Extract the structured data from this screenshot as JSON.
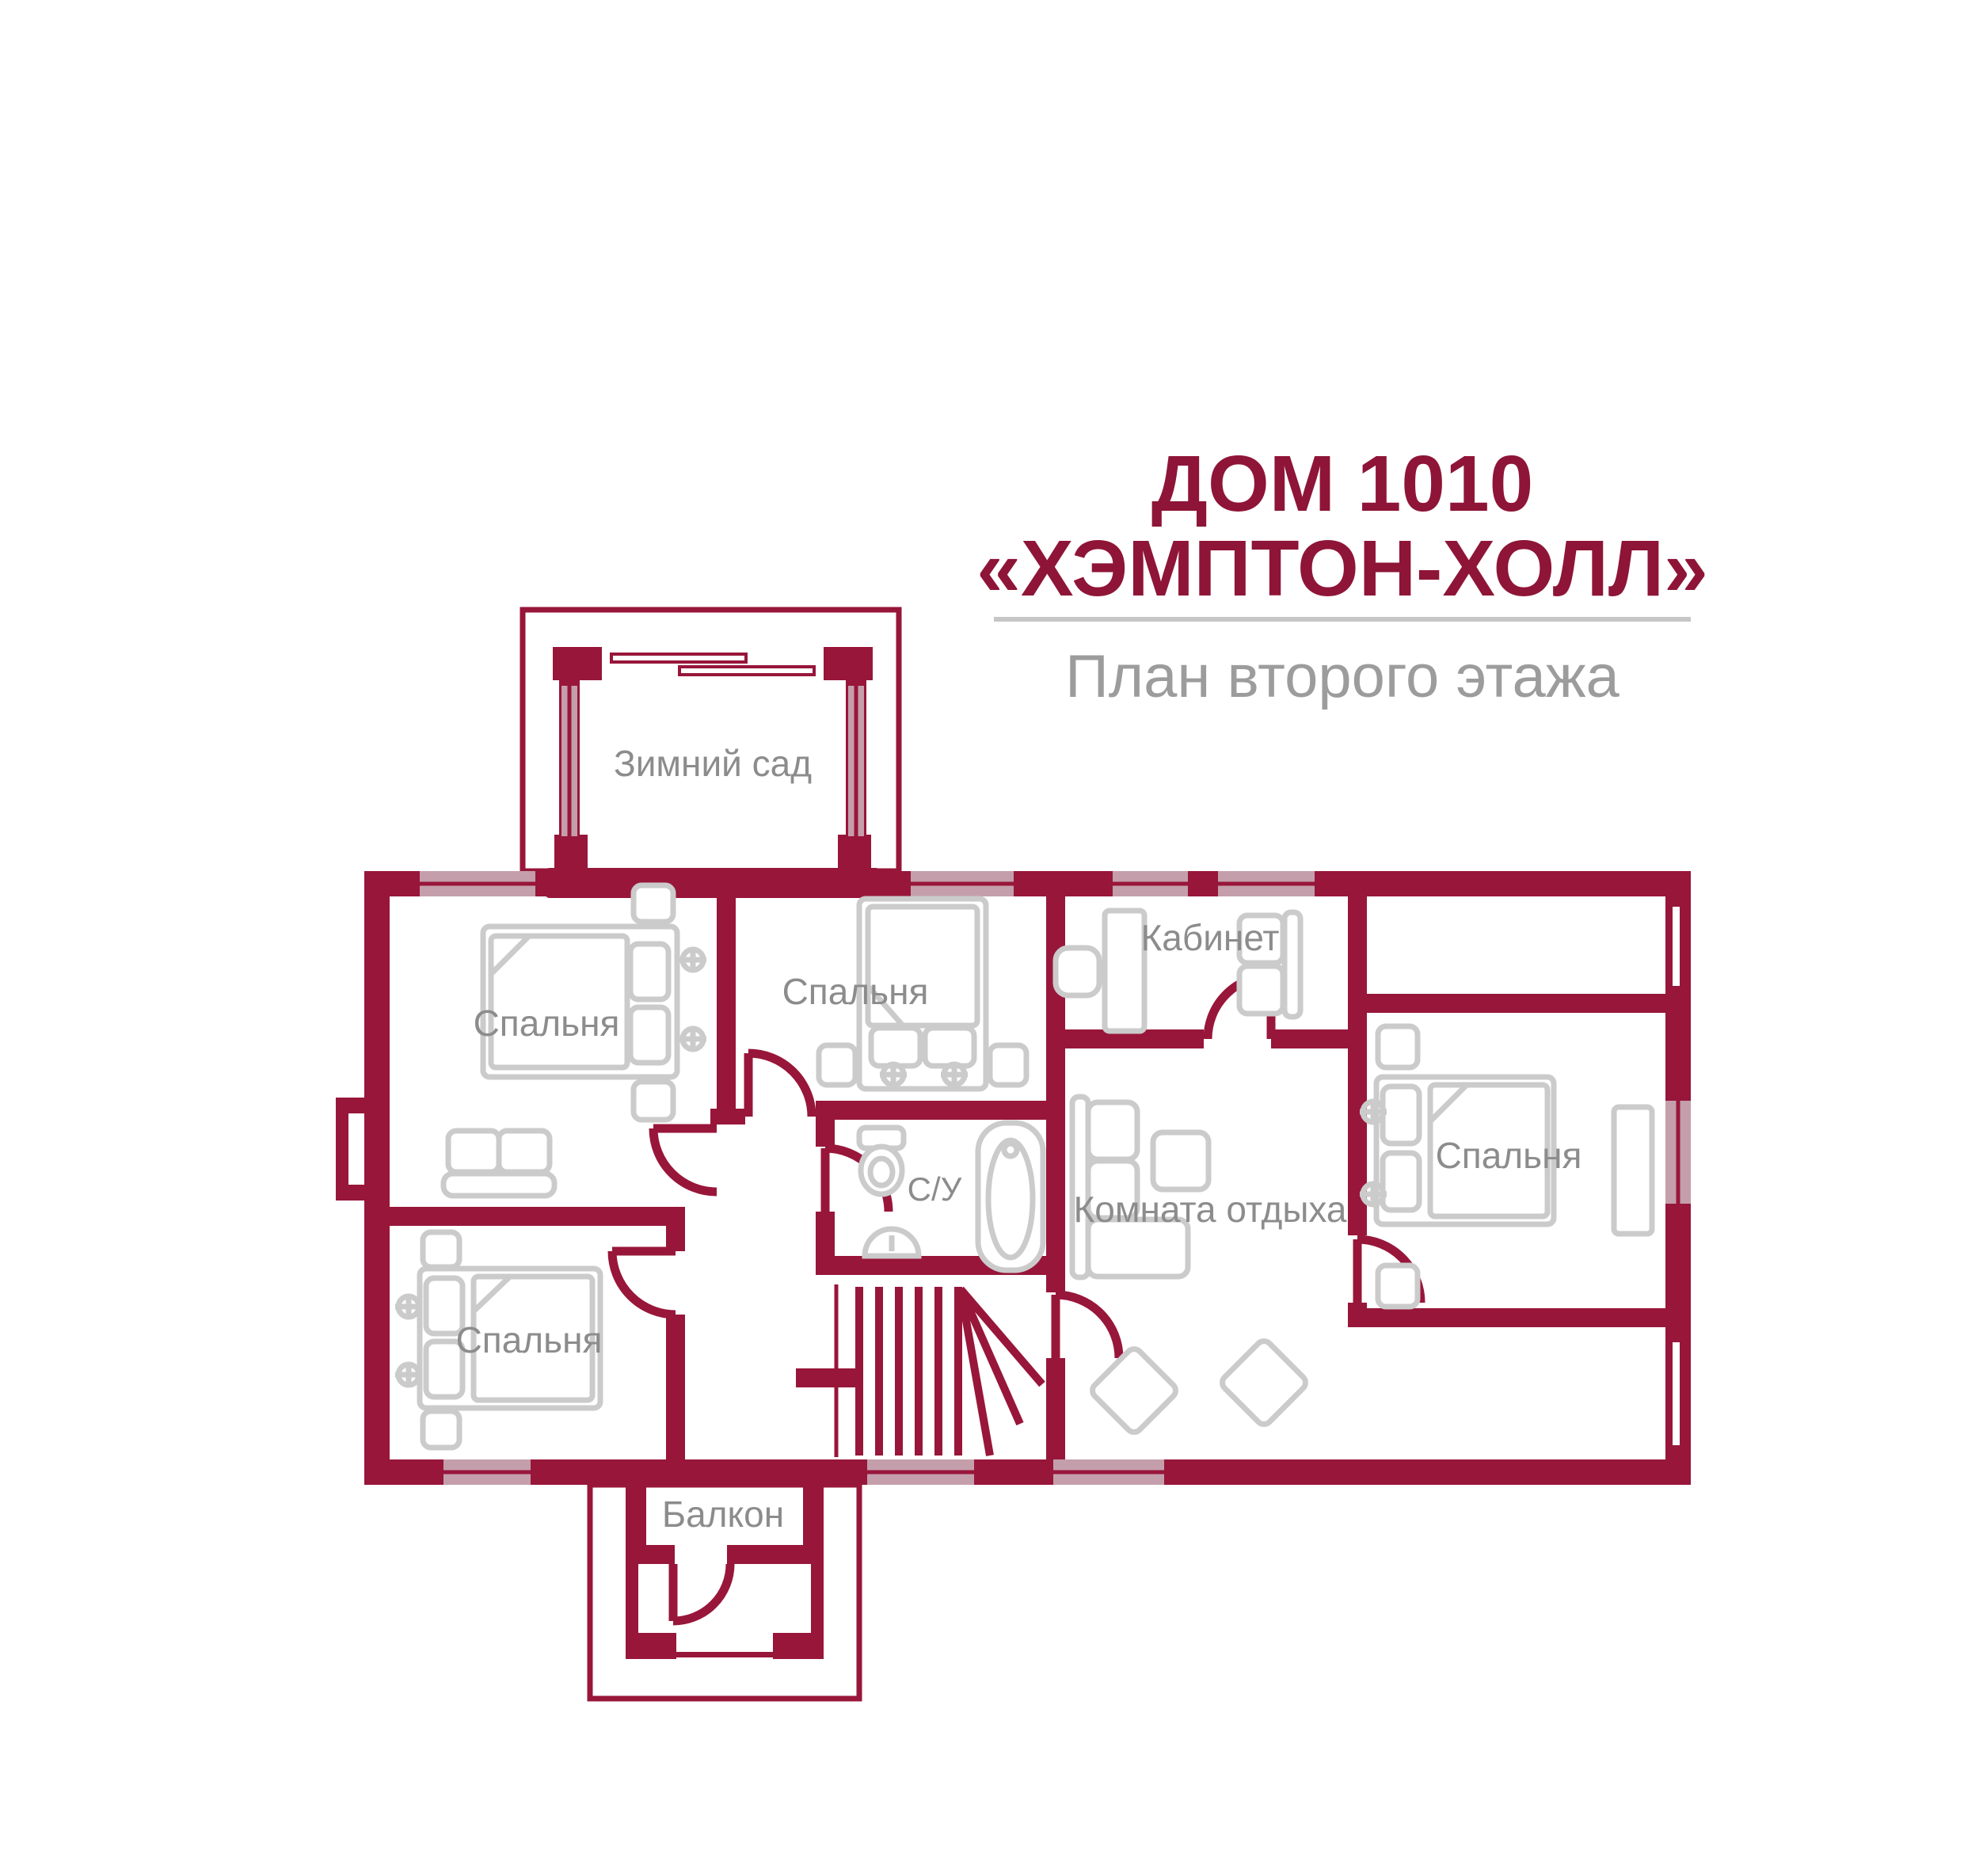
{
  "title": {
    "line1": "ДОМ 1010",
    "line2": "«ХЭМПТОН-ХОЛЛ»",
    "subtitle": "План второго этажа"
  },
  "rooms": {
    "winter_garden": "Зимний сад",
    "bedroom_top_left": "Спальня",
    "bedroom_top_middle": "Спальня",
    "study": "Кабинет",
    "bathroom": "С/У",
    "lounge": "Комната отдыха",
    "bedroom_right": "Спальня",
    "bedroom_bottom_left": "Спальня",
    "balcony": "Балкон"
  },
  "colors": {
    "wall": "#98163A",
    "window_glass": "#C49FAB",
    "furniture_outline": "#CBCBCB",
    "room_label": "#8C8C8C",
    "title_text": "#8E1537",
    "subtitle_text": "#9C9C9C",
    "divider_line": "#C6C6C6"
  }
}
